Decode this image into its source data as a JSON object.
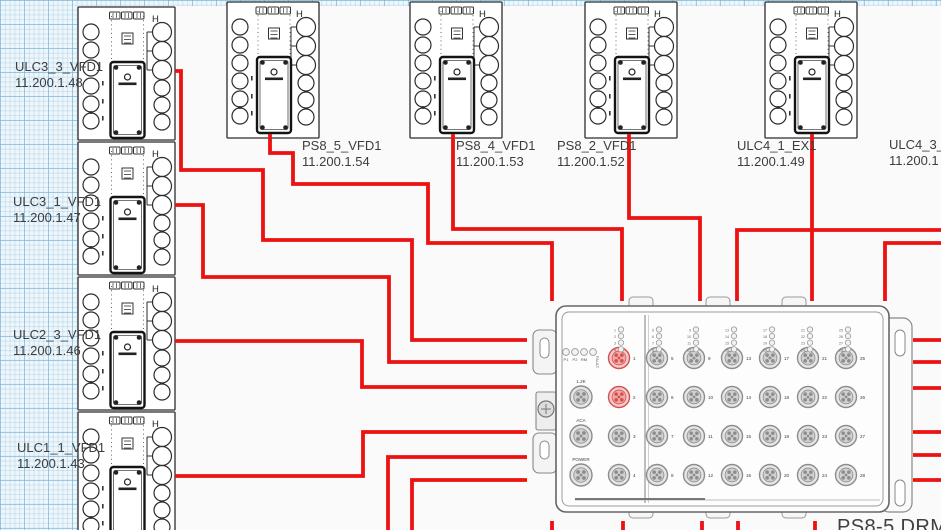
{
  "wire_color": "#ec1212",
  "canvas": {
    "grid_color": "#aed4e8",
    "page_color": "#fafafa"
  },
  "labels": {
    "left": [
      {
        "name": "ULC3_3_VFD1",
        "ip": "11.200.1.48"
      },
      {
        "name": "ULC3_1_VFD1",
        "ip": "11.200.1.47"
      },
      {
        "name": "ULC2_3_VFD1",
        "ip": "11.200.1.46"
      },
      {
        "name": "ULC1_1_VFD1",
        "ip": "11.200.1.43"
      }
    ],
    "top": [
      {
        "name": "PS8_5_VFD1",
        "ip": "11.200.1.54"
      },
      {
        "name": "PS8_4_VFD1",
        "ip": "11.200.1.53"
      },
      {
        "name": "PS8_2_VFD1",
        "ip": "11.200.1.52"
      },
      {
        "name": "ULC4_1_EX1",
        "ip": "11.200.1.49"
      }
    ],
    "right_truncated": {
      "name": "ULC4_3_",
      "ip": "11.200.1"
    },
    "bottom_title": "PS8-5 DRM1"
  },
  "vfd_module": {
    "marker": "H"
  },
  "drm": {
    "status_leds": [
      "P1",
      "P2",
      "RM",
      "FAULT"
    ],
    "side_connectors": [
      "1.2K",
      "ACA",
      "POWER"
    ],
    "ports_total": 28,
    "ports_per_column": 4,
    "highlighted_ports": [
      1,
      2
    ]
  }
}
